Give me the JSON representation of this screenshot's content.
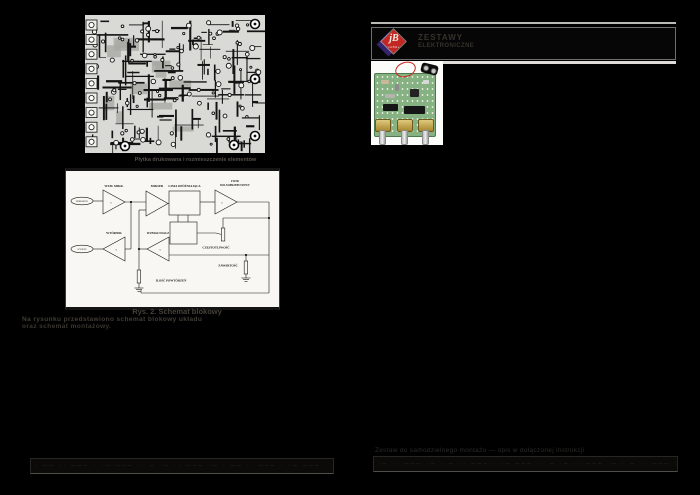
{
  "colors": {
    "page_bg": "#000000",
    "scan_bg": "#d9d9d5",
    "diagram_bg": "#f8f7f3",
    "logo_red": "#c32723",
    "logo_purple": "#33246b",
    "pcb_green": "#85b183",
    "pot_gold": "#c3a244"
  },
  "left": {
    "scan_caption": "Płytka drukowana i rozmieszczenie elementów",
    "diagram": {
      "mic": "MIKROFON",
      "out": "WYJŚCIE",
      "amp_mic": "WZM. MIKR.",
      "mixer": "MIKSER",
      "delay": "LINIA OPÓŹNIAJĄCA",
      "filter1": "FILTR",
      "filter2": "DOLNOPRZEPUSTOWY",
      "buffer": "WTÓRNIK",
      "amp": "WZMACNIACZ",
      "freq": "CZĘSTOTLIWOŚĆ",
      "depth": "ZAWARTOŚĆ",
      "repeats": "ILOŚĆ POWTÓRZEŃ",
      "mark_fwd": ">",
      "mark_back": "<"
    },
    "diagram_caption": "Rys. 2. Schemat blokowy",
    "body_line1": "Na rysunku przedstawiono schemat blokowy układu",
    "body_line2": "oraz schemat montażowy.",
    "footer_marks": "· –– ·· ––– · ·– ––– ·· – ·– ·· ––– ·– · –– ·· ––– · ·– ––– ·· – ·– ·· –––"
  },
  "right": {
    "logo_letters": "jB",
    "logo_name": "JABEL",
    "side_line1": "ZESTAWY",
    "side_line2": "ELEKTRONICZNE",
    "caption_line": "Zestaw do samodzielnego montażu — opis w dołączonej instrukcji",
    "footer_marks": "·– ·· ––– ·– · – ·· ––– · ·– ––– ·· – ·– ·· ––– ·– · – ·· ––– · ·– ––– ·· –"
  }
}
